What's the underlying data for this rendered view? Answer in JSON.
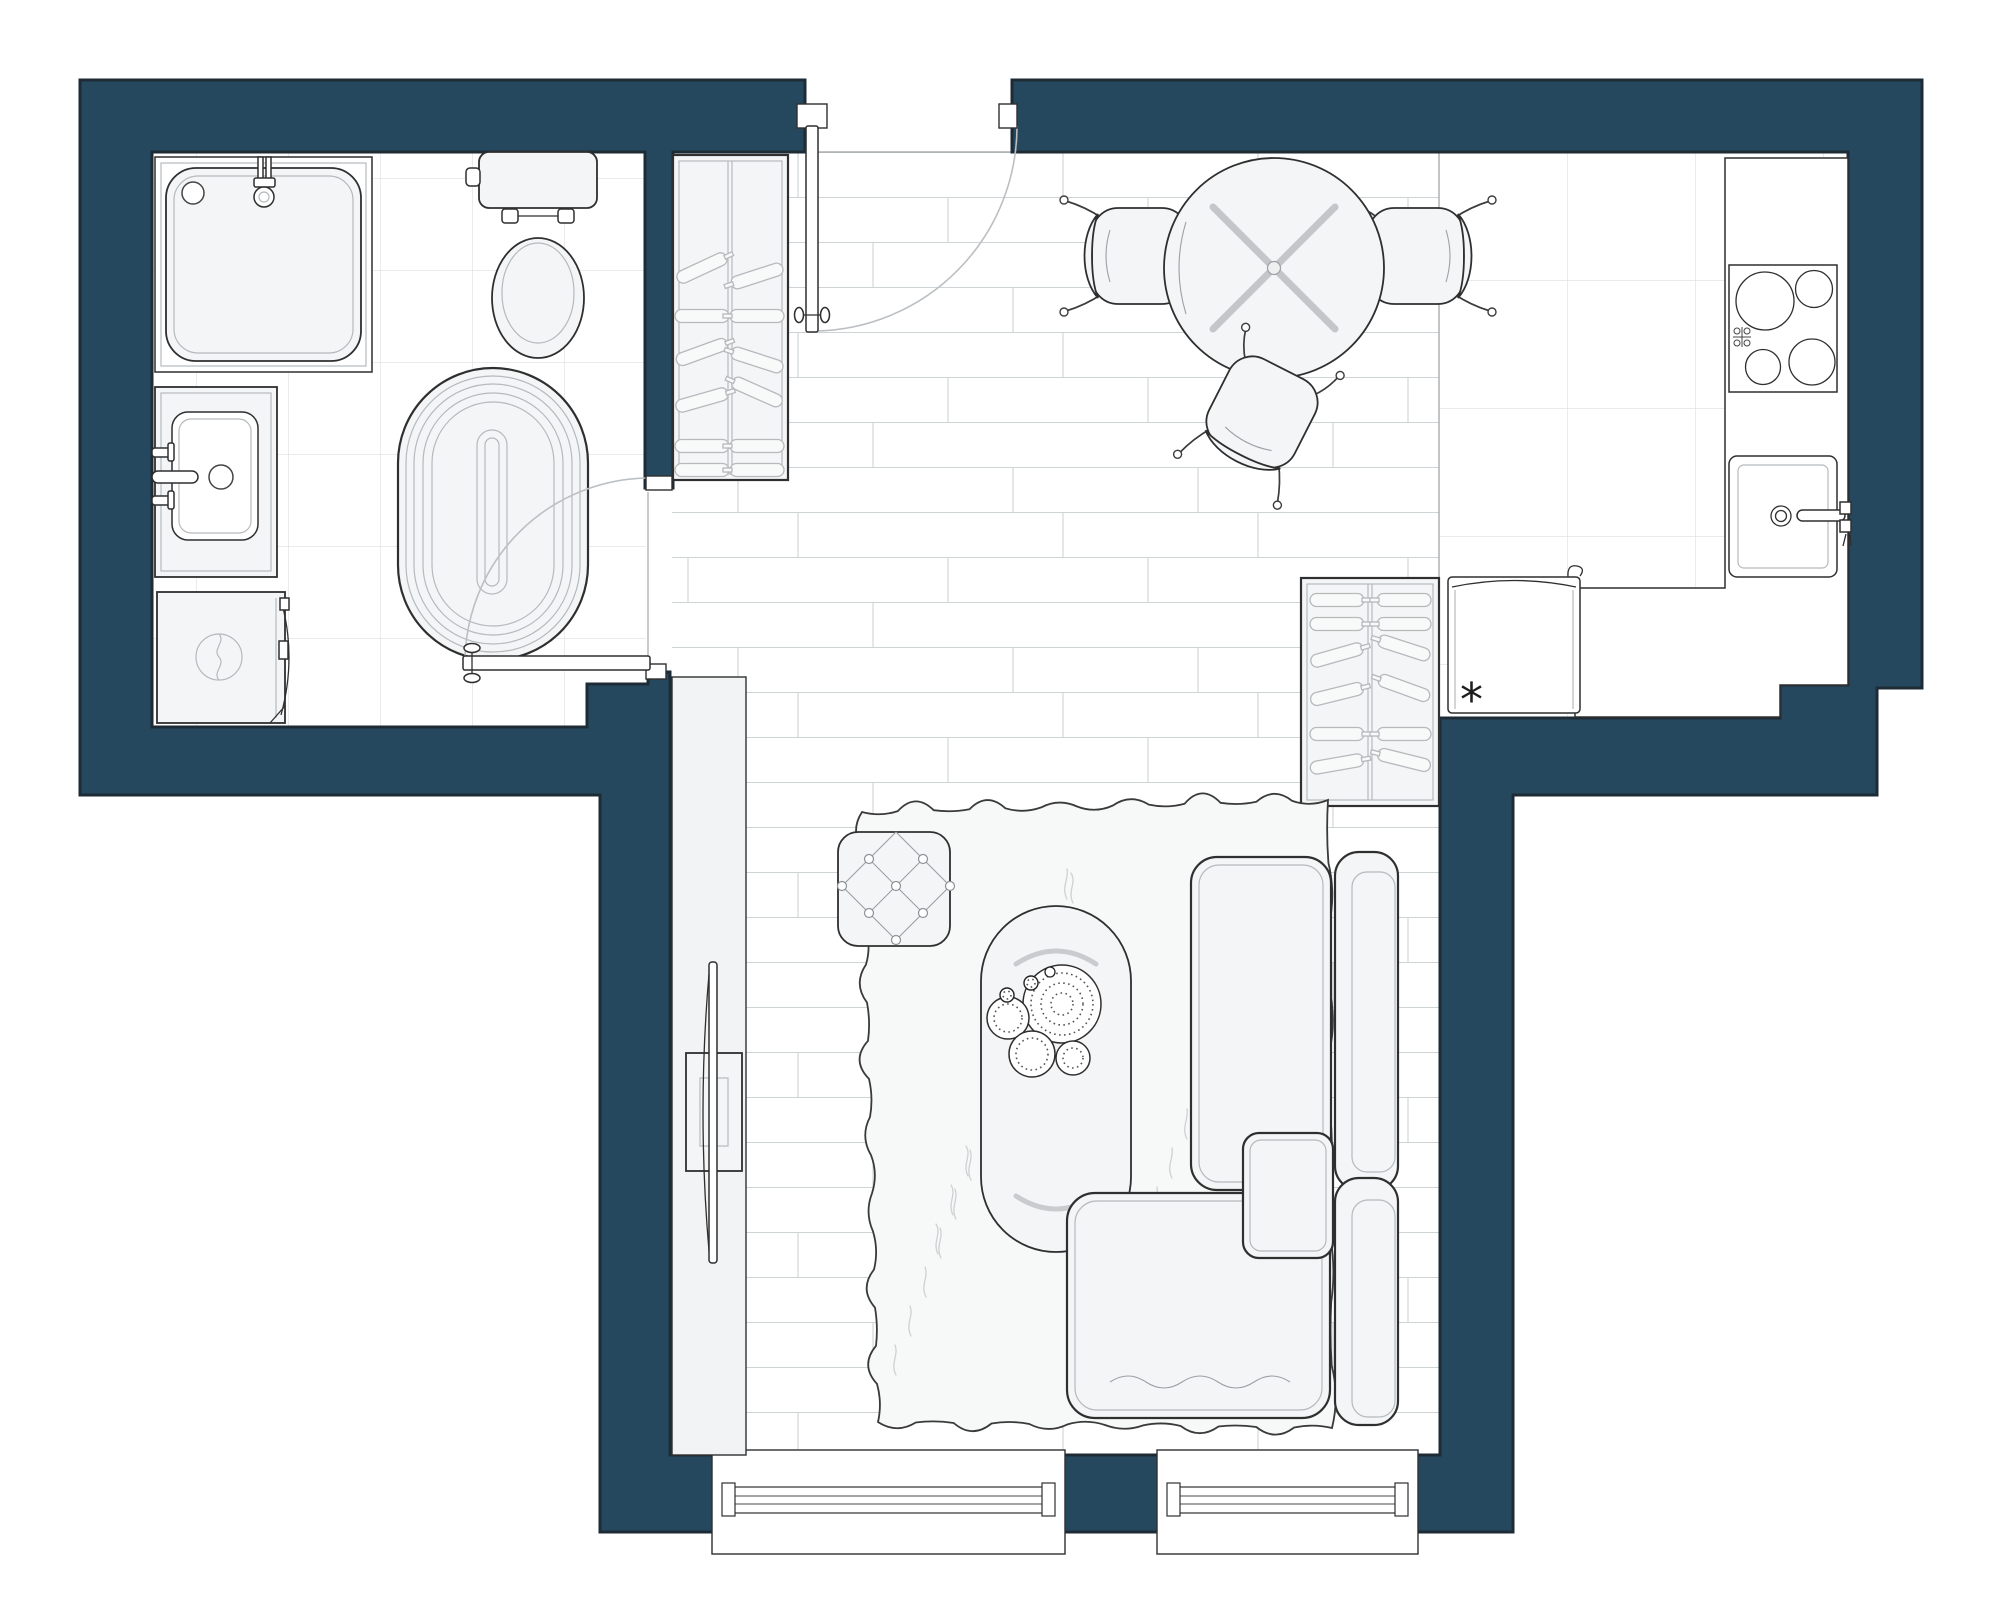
{
  "plan": {
    "kind": "apartment-floor-plan",
    "fridge_symbol": "*"
  },
  "colors": {
    "wall": "#26485f",
    "wall_outline": "#1d2b36",
    "fixture_fill": "#f4f5f6",
    "fixture_stroke": "#2f2f2f",
    "detail_line": "#9aa0a4",
    "soft_line": "#b5babd",
    "tile_line": "#dadddf",
    "plank_line": "#ced3d6",
    "swing_line": "#bcc0c3",
    "rug_fill": "#f7f8f8",
    "fur_line": "#cdd1d4"
  }
}
